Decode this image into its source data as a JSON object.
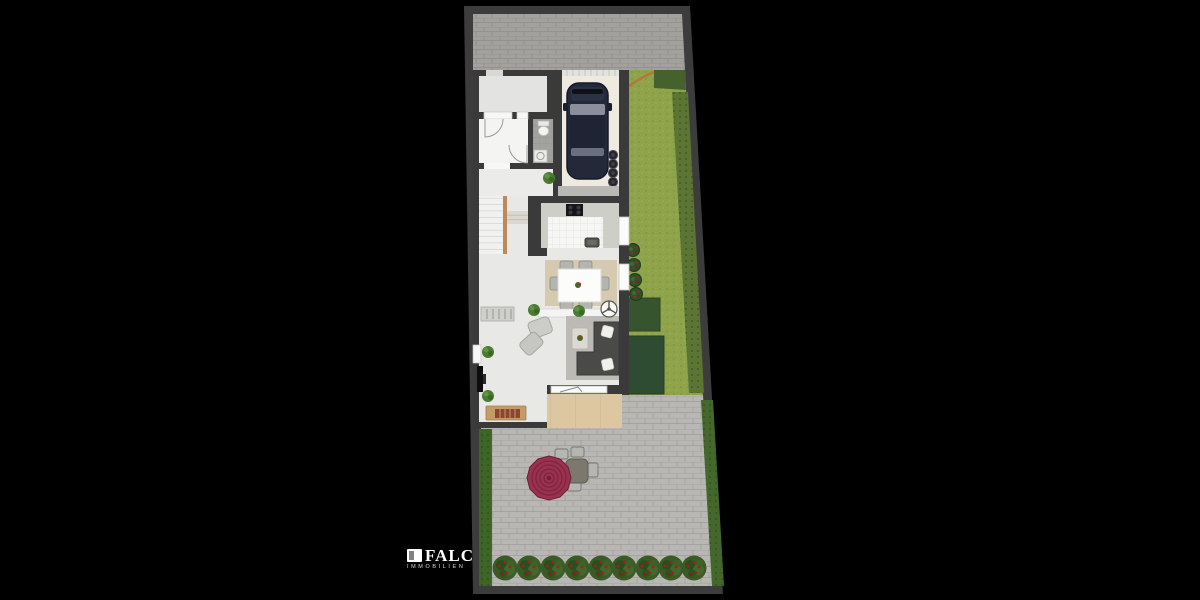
{
  "scene": {
    "type": "floor-plan-rendering",
    "description": "Top-down rendered site plan: paved driveway, house with garage and car, garden lawn, paved patio with parasol seating, flowering hedge"
  },
  "watermark": {
    "brand": "FALC",
    "subline": "IMMOBILIEN"
  },
  "palette": {
    "background": "#000000",
    "border": "#3c3c3c",
    "wall": "#3a3a3a",
    "driveway": "#a2a19e",
    "patio": "#b8b7b3",
    "lawn": "#8ea34a",
    "lawn_hedge": "#5d7534",
    "hedge_block_a": "#36552e",
    "hedge_block_b": "#2e4c31",
    "hedge_strip": "#3f6428",
    "floor": "#e8e8e6",
    "room_floor": "#e3e3e1",
    "garage_floor": "#efeadf",
    "kitchen_tile": "#f6f6f4",
    "bath_tile": "#a2a29e",
    "counter": "#cecec9",
    "dining_rug": "#d5caaf",
    "living_rug": "#bcbab5",
    "sofa": "#4a4a48",
    "terrace": "#dcc7a1",
    "car": "#232938",
    "parasol": "#9a3150",
    "stair_wood": "#bd8a55",
    "bench_wood": "#c49a67",
    "plant_green": "#4a7b32",
    "berry_red": "#9c2026"
  },
  "inventory": {
    "flowering_bushes": 9,
    "garage_bins": 4,
    "lawn_pots": 4,
    "dining_chairs": 6,
    "patio_chairs": 4,
    "armchairs": 2,
    "parasols": 1,
    "cars": 1
  },
  "repeats": {
    "bushes": {
      "y": 568,
      "xs": [
        505,
        529,
        553,
        577,
        601,
        624,
        648,
        671,
        694
      ]
    },
    "bins": {
      "x": 613,
      "ys": [
        155,
        164,
        173,
        182
      ]
    },
    "lawn_pots": [
      [
        633,
        250
      ],
      [
        634,
        265
      ],
      [
        635,
        280
      ],
      [
        636,
        294
      ]
    ],
    "plants": [
      [
        549,
        178
      ],
      [
        534,
        310
      ],
      [
        579,
        311
      ],
      [
        488,
        352
      ],
      [
        488,
        396
      ]
    ]
  }
}
